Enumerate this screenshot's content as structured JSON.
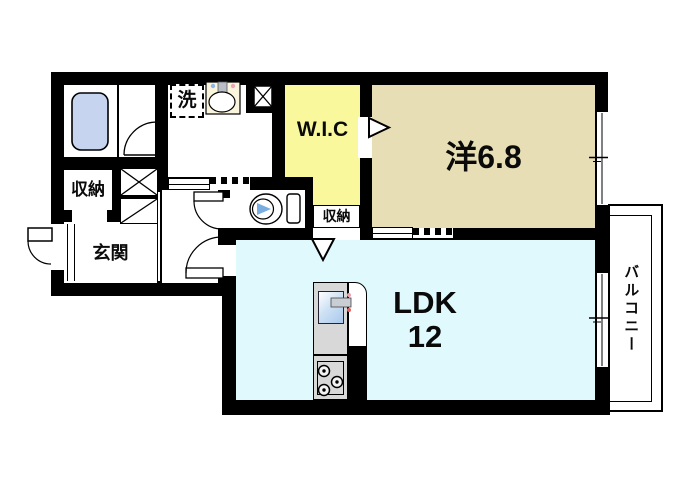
{
  "plan": {
    "title": "1LDK apartment floor plan",
    "rooms": {
      "western": {
        "label": "洋6.8"
      },
      "ldk": {
        "line1": "LDK",
        "line2": "12"
      },
      "wic": {
        "label": "W.I.C"
      },
      "closet_wic": {
        "label": "収納"
      },
      "closet_entry": {
        "label": "収納"
      },
      "entrance": {
        "label": "玄関"
      },
      "laundry": {
        "label": "洗"
      },
      "balcony": {
        "label": "バルコニー"
      }
    },
    "fixtures": [
      "bathtub",
      "toilet",
      "washbasin",
      "washing-machine-space",
      "kitchen-sink",
      "gas-stove",
      "balcony-window",
      "bedroom-window"
    ],
    "colors": {
      "wall": "#000000",
      "western_room": "#e8deb5",
      "wic": "#f9f89d",
      "ldk": "#e0f9fd",
      "bathtub": "#c7d4ef",
      "toilet_lid": "#7aade0",
      "basin_bg": "#faf5dc",
      "kitchen": "#d8d8d8"
    }
  }
}
